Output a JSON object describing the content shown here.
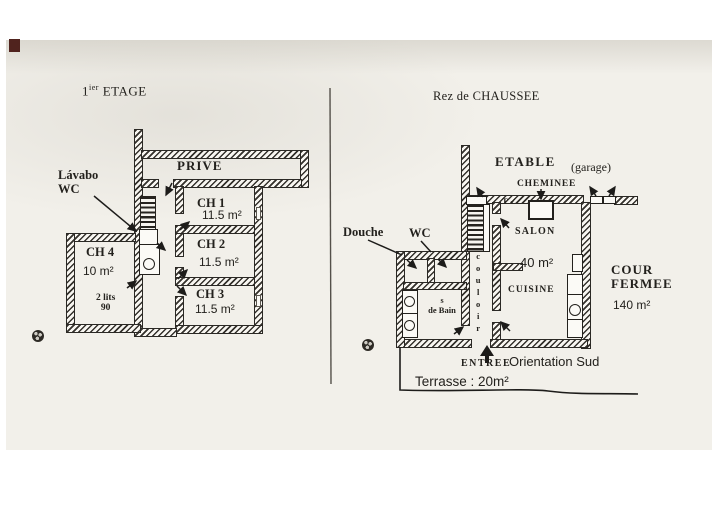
{
  "colors": {
    "page_bg": "#f2f0ea",
    "ink": "#23211d",
    "wall_fill": "#f8f6f1",
    "divider": "#54504a",
    "corner_mark": "#50231e"
  },
  "floor1": {
    "title": {
      "num": "1",
      "sup": "ier",
      "rest": "ETAGE"
    },
    "labels": {
      "prive": "PRIVE",
      "lavabo_line1": "Lávabo",
      "lavabo_line2": "WC"
    },
    "rooms": [
      {
        "name": "CH 1",
        "area": "11.5 m²"
      },
      {
        "name": "CH 2",
        "area": "11.5 m²"
      },
      {
        "name": "CH 3",
        "area": "11.5 m²"
      },
      {
        "name": "CH 4",
        "area": "10 m²",
        "beds_line1": "2 lits",
        "beds_line2": "90"
      }
    ]
  },
  "floor0": {
    "title": "Rez de CHAUSSEE",
    "labels": {
      "etable": "ETABLE",
      "garage": "(garage)",
      "cheminee": "CHEMINEE",
      "douche": "Douche",
      "wc": "WC",
      "salon": "SALON",
      "salon_area": "40 m²",
      "cuisine": "CUISINE",
      "couloir": "couloir",
      "tv": "T ✓",
      "cour_line1": "COUR",
      "cour_line2": "FERMEE",
      "cour_area": "140 m²",
      "sdb_line1": "s",
      "sdb_line2": "de Bain",
      "entree": "ENTREE",
      "orientation": "Orientation Sud",
      "terrasse": "Terrasse : 20m²"
    }
  }
}
